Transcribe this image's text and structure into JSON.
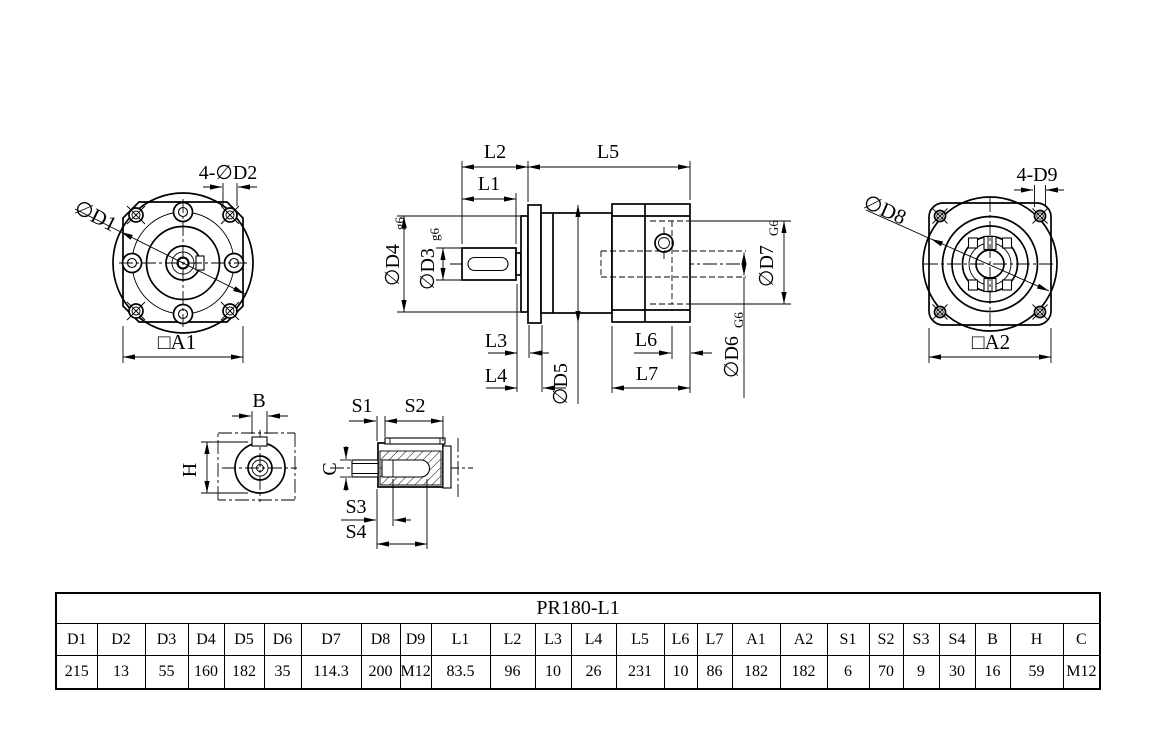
{
  "table": {
    "title": "PR180-L1",
    "headers": [
      "D1",
      "D2",
      "D3",
      "D4",
      "D5",
      "D6",
      "D7",
      "D8",
      "D9",
      "L1",
      "L2",
      "L3",
      "L4",
      "L5",
      "L6",
      "L7",
      "A1",
      "A2",
      "S1",
      "S2",
      "S3",
      "S4",
      "B",
      "H",
      "C"
    ],
    "values": [
      "215",
      "13",
      "55",
      "160",
      "182",
      "35",
      "114.3",
      "200",
      "M12",
      "83.5",
      "96",
      "10",
      "26",
      "231",
      "10",
      "86",
      "182",
      "182",
      "6",
      "70",
      "9",
      "30",
      "16",
      "59",
      "M12"
    ]
  },
  "front_view": {
    "bolt_holes": "4-∅D2",
    "flange_diameter": "∅D1",
    "square_size": "□A1"
  },
  "rear_view": {
    "bolt_holes": "4-D9",
    "flange_diameter": "∅D8",
    "square_size": "□A2"
  },
  "side_view": {
    "l1": "L1",
    "l2": "L2",
    "l3": "L3",
    "l4": "L4",
    "l5": "L5",
    "l6": "L6",
    "l7": "L7",
    "d3": "∅D3",
    "d3_fit": "g6",
    "d4": "∅D4",
    "d4_fit": "g6",
    "d5": "∅D5",
    "d6": "∅D6",
    "d6_fit": "G6",
    "d7": "∅D7",
    "d7_fit": "G6"
  },
  "section_view": {
    "b": "B",
    "h": "H"
  },
  "shaft_detail": {
    "s1": "S1",
    "s2": "S2",
    "s3": "S3",
    "s4": "S4",
    "c": "C"
  }
}
